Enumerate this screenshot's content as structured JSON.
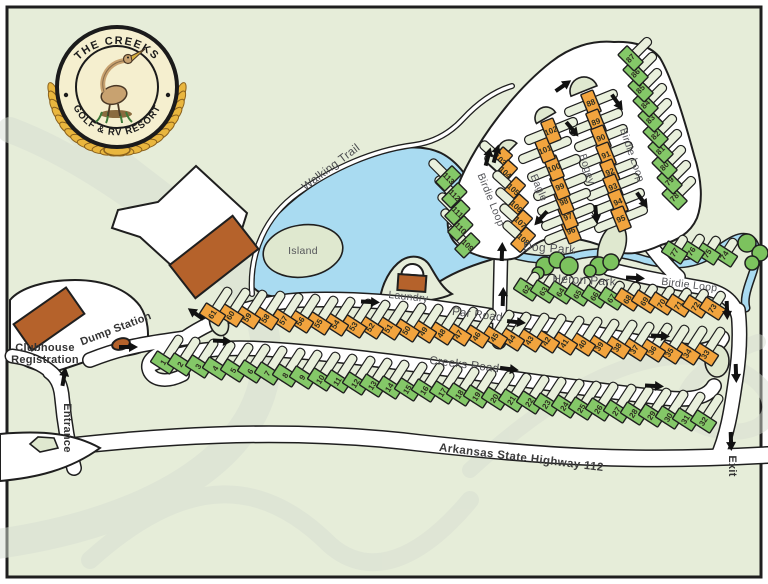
{
  "logo": {
    "line1": "THE CREEKS",
    "line2": "GOLF & RV RESORT"
  },
  "labels": {
    "walking_trail": "Walking Trail",
    "island": "Island",
    "laundry": "Laundry",
    "dog_park": "Dog Park",
    "heron_park": "Heron Park",
    "birdie_loop_west": "Birdie Loop",
    "birdie_loop_east": "Birdie Loop",
    "birdie_loop_south": "Birdie Loop",
    "eagle": "Eagle",
    "bogey": "Bogey",
    "par_road": "Par Road",
    "creeks_road": "Creeks Road",
    "highway": "Arkansas State Highway 112",
    "entrance": "Entrance",
    "exit": "Exit",
    "clubhouse_1": "Clubhouse",
    "clubhouse_2": "Registration",
    "dump_station": "Dump Station"
  },
  "palette": {
    "map_bg": "#e6edd9",
    "site_green": "#84c868",
    "site_orange": "#f2a43e",
    "water": "#a9dbf1",
    "building": "#b5622b",
    "gold": "#e9b63e"
  },
  "sites": [
    [
      1,
      160,
      368,
      33,
      "g",
      "e",
      38
    ],
    [
      2,
      177,
      370,
      33,
      "g",
      "e",
      38
    ],
    [
      3,
      195,
      372,
      33,
      "g",
      "e",
      38
    ],
    [
      4,
      212,
      374,
      33,
      "g",
      "e",
      38
    ],
    [
      5,
      230,
      376,
      33,
      "g",
      "e",
      38
    ],
    [
      6,
      247,
      377,
      33,
      "g",
      "e",
      38
    ],
    [
      7,
      264,
      379,
      33,
      "g",
      "e",
      38
    ],
    [
      8,
      282,
      381,
      33,
      "g",
      "e",
      38
    ],
    [
      9,
      299,
      383,
      33,
      "g",
      "e",
      38
    ],
    [
      10,
      317,
      385,
      33,
      "g",
      "e",
      38
    ],
    [
      11,
      334,
      387,
      33,
      "g",
      "e",
      38
    ],
    [
      12,
      352,
      389,
      33,
      "g",
      "e",
      38
    ],
    [
      13,
      369,
      391,
      33,
      "g",
      "e",
      38
    ],
    [
      14,
      386,
      393,
      33,
      "g",
      "e",
      38
    ],
    [
      15,
      404,
      395,
      33,
      "g",
      "e",
      38
    ],
    [
      16,
      421,
      396,
      33,
      "g",
      "e",
      38
    ],
    [
      17,
      439,
      398,
      33,
      "g",
      "e",
      38
    ],
    [
      18,
      456,
      400,
      33,
      "g",
      "e",
      38
    ],
    [
      19,
      473,
      402,
      33,
      "g",
      "e",
      38
    ],
    [
      20,
      491,
      404,
      33,
      "g",
      "e",
      38
    ],
    [
      21,
      508,
      406,
      33,
      "g",
      "e",
      38
    ],
    [
      22,
      526,
      408,
      33,
      "g",
      "e",
      38
    ],
    [
      23,
      543,
      410,
      33,
      "g",
      "e",
      38
    ],
    [
      24,
      561,
      412,
      33,
      "g",
      "e",
      38
    ],
    [
      25,
      578,
      414,
      33,
      "g",
      "e",
      38
    ],
    [
      26,
      595,
      415,
      33,
      "g",
      "e",
      38
    ],
    [
      27,
      613,
      417,
      33,
      "g",
      "e",
      38
    ],
    [
      28,
      630,
      419,
      33,
      "g",
      "e",
      38
    ],
    [
      29,
      648,
      421,
      33,
      "g",
      "e",
      38
    ],
    [
      30,
      665,
      423,
      33,
      "g",
      "e",
      38
    ],
    [
      31,
      682,
      425,
      33,
      "g",
      "e",
      38
    ],
    [
      32,
      700,
      427,
      33,
      "g",
      "e",
      38
    ],
    [
      33,
      702,
      360,
      33,
      "o",
      "e",
      38
    ],
    [
      34,
      684,
      359,
      33,
      "o",
      "e",
      38
    ],
    [
      35,
      666,
      358,
      33,
      "o",
      "e",
      38
    ],
    [
      36,
      649,
      356,
      33,
      "o",
      "e",
      38
    ],
    [
      37,
      631,
      355,
      33,
      "o",
      "e",
      38
    ],
    [
      38,
      614,
      353,
      33,
      "o",
      "e",
      38
    ],
    [
      39,
      596,
      352,
      33,
      "o",
      "e",
      38
    ],
    [
      40,
      579,
      350,
      33,
      "o",
      "e",
      38
    ],
    [
      41,
      561,
      349,
      33,
      "o",
      "e",
      38
    ],
    [
      42,
      543,
      347,
      33,
      "o",
      "e",
      38
    ],
    [
      43,
      526,
      346,
      33,
      "o",
      "e",
      38
    ],
    [
      44,
      508,
      345,
      33,
      "o",
      "e",
      38
    ],
    [
      45,
      491,
      343,
      33,
      "o",
      "e",
      38
    ],
    [
      46,
      473,
      342,
      33,
      "o",
      "e",
      38
    ],
    [
      47,
      455,
      340,
      33,
      "o",
      "e",
      38
    ],
    [
      48,
      438,
      339,
      33,
      "o",
      "e",
      38
    ],
    [
      49,
      420,
      337,
      33,
      "o",
      "e",
      38
    ],
    [
      50,
      403,
      336,
      33,
      "o",
      "e",
      38
    ],
    [
      51,
      385,
      334,
      33,
      "o",
      "e",
      38
    ],
    [
      52,
      367,
      333,
      33,
      "o",
      "e",
      38
    ],
    [
      53,
      350,
      332,
      33,
      "o",
      "e",
      38
    ],
    [
      54,
      332,
      330,
      33,
      "o",
      "e",
      38
    ],
    [
      55,
      315,
      329,
      33,
      "o",
      "e",
      38
    ],
    [
      56,
      297,
      327,
      33,
      "o",
      "e",
      38
    ],
    [
      57,
      280,
      326,
      33,
      "o",
      "e",
      38
    ],
    [
      58,
      262,
      324,
      33,
      "o",
      "e",
      38
    ],
    [
      59,
      244,
      323,
      33,
      "o",
      "e",
      38
    ],
    [
      60,
      227,
      321,
      33,
      "o",
      "e",
      38
    ],
    [
      61,
      209,
      320,
      33,
      "o",
      "e",
      38
    ],
    [
      62,
      523,
      295,
      33,
      "g",
      "e",
      26
    ],
    [
      63,
      540,
      297,
      33,
      "g",
      "e",
      26
    ],
    [
      64,
      557,
      298,
      33,
      "g",
      "e",
      26
    ],
    [
      65,
      574,
      300,
      33,
      "g",
      "e",
      26
    ],
    [
      66,
      591,
      302,
      33,
      "g",
      "e",
      26
    ],
    [
      67,
      608,
      304,
      33,
      "g",
      "e",
      26
    ],
    [
      68,
      624,
      305,
      33,
      "o",
      "e",
      26
    ],
    [
      69,
      641,
      307,
      33,
      "o",
      "e",
      26
    ],
    [
      70,
      658,
      309,
      33,
      "o",
      "e",
      26
    ],
    [
      71,
      675,
      311,
      33,
      "o",
      "e",
      26
    ],
    [
      72,
      692,
      312,
      33,
      "o",
      "e",
      26
    ],
    [
      73,
      709,
      314,
      33,
      "o",
      "e",
      26
    ],
    [
      74,
      721,
      261,
      33,
      "g",
      "e",
      26
    ],
    [
      75,
      704,
      259,
      33,
      "g",
      "e",
      26
    ],
    [
      76,
      688,
      257,
      33,
      "g",
      "e",
      26
    ],
    [
      77,
      671,
      258,
      33,
      "g",
      "e",
      26
    ],
    [
      78,
      670,
      202,
      45,
      "g",
      "e",
      34
    ],
    [
      79,
      665,
      186,
      45,
      "g",
      "e",
      34
    ],
    [
      80,
      660,
      171,
      45,
      "g",
      "e",
      34
    ],
    [
      81,
      656,
      155,
      45,
      "g",
      "e",
      34
    ],
    [
      82,
      651,
      140,
      45,
      "g",
      "e",
      34
    ],
    [
      83,
      646,
      124,
      45,
      "g",
      "e",
      34
    ],
    [
      84,
      641,
      109,
      45,
      "g",
      "e",
      34
    ],
    [
      85,
      636,
      94,
      45,
      "g",
      "e",
      34
    ],
    [
      86,
      631,
      78,
      45,
      "g",
      "e",
      34
    ],
    [
      87,
      626,
      63,
      45,
      "g",
      "e",
      34
    ],
    [
      88,
      591,
      103,
      68,
      "o",
      "t",
      56
    ],
    [
      89,
      596,
      122,
      68,
      "o",
      "t",
      56
    ],
    [
      90,
      601,
      138,
      68,
      "o",
      "t",
      56
    ],
    [
      91,
      606,
      155,
      68,
      "o",
      "t",
      56
    ],
    [
      92,
      610,
      172,
      68,
      "o",
      "t",
      56
    ],
    [
      93,
      613,
      187,
      68,
      "o",
      "t",
      56
    ],
    [
      94,
      618,
      202,
      68,
      "o",
      "t",
      56
    ],
    [
      95,
      621,
      219,
      68,
      "o",
      "t",
      56
    ],
    [
      96,
      571,
      231,
      68,
      "o",
      "t",
      56
    ],
    [
      97,
      568,
      217,
      68,
      "o",
      "t",
      56
    ],
    [
      98,
      564,
      202,
      68,
      "o",
      "t",
      56
    ],
    [
      99,
      560,
      187,
      68,
      "o",
      "t",
      56
    ],
    [
      100,
      554,
      168,
      68,
      "o",
      "t",
      56
    ],
    [
      101,
      545,
      150,
      68,
      "o",
      "t",
      56
    ],
    [
      102,
      551,
      131,
      68,
      "o",
      "t",
      56
    ],
    [
      103,
      505,
      164,
      -48,
      "o",
      "e",
      32
    ],
    [
      104,
      510,
      177,
      -48,
      "o",
      "e",
      32
    ],
    [
      105,
      518,
      194,
      -48,
      "o",
      "e",
      32
    ],
    [
      106,
      521,
      211,
      -48,
      "o",
      "e",
      32
    ],
    [
      107,
      525,
      227,
      -48,
      "o",
      "e",
      32
    ],
    [
      108,
      528,
      244,
      -48,
      "o",
      "e",
      32
    ],
    [
      109,
      472,
      250,
      -45,
      "g",
      "e",
      32
    ],
    [
      110,
      465,
      233,
      -45,
      "g",
      "e",
      32
    ],
    [
      111,
      462,
      217,
      -45,
      "g",
      "e",
      32
    ],
    [
      112,
      459,
      200,
      -45,
      "g",
      "e",
      32
    ],
    [
      113,
      453,
      183,
      -45,
      "g",
      "e",
      32
    ]
  ],
  "arrows": [
    [
      128,
      347,
      0
    ],
    [
      222,
      341,
      3
    ],
    [
      370,
      302,
      3
    ],
    [
      516,
      322,
      6
    ],
    [
      509,
      369,
      7
    ],
    [
      64,
      377,
      -80
    ],
    [
      196,
      314,
      -145
    ],
    [
      488,
      157,
      -75
    ],
    [
      496,
      154,
      -75
    ],
    [
      563,
      86,
      -35
    ],
    [
      617,
      102,
      55
    ],
    [
      572,
      129,
      50
    ],
    [
      541,
      218,
      132
    ],
    [
      596,
      214,
      85
    ],
    [
      642,
      200,
      55
    ],
    [
      502,
      252,
      -88
    ],
    [
      503,
      297,
      -88
    ],
    [
      635,
      278,
      3
    ],
    [
      660,
      336,
      3
    ],
    [
      654,
      386,
      3
    ],
    [
      727,
      310,
      88
    ],
    [
      736,
      373,
      88
    ],
    [
      731,
      441,
      88
    ]
  ]
}
